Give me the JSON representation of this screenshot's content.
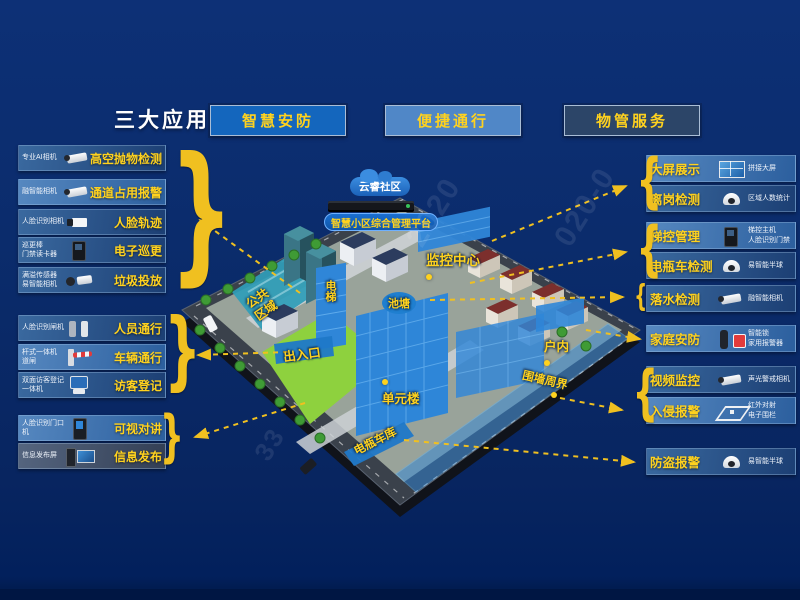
{
  "title": "三大应用",
  "apps": [
    {
      "label": "智慧安防"
    },
    {
      "label": "便捷通行"
    },
    {
      "label": "物管服务"
    }
  ],
  "colors": {
    "background": "#0b2c6c",
    "accent_yellow": "#ffd21e",
    "arrow_yellow": "#f0c020",
    "app1_bg": "#1466bd",
    "app2_bg": "#5087c7",
    "app3_bg": "#2c4568",
    "highlight_blue": "#2f86d8"
  },
  "left_groups": [
    {
      "items": [
        {
          "device": "专业AI相机",
          "feature": "高空抛物检测",
          "icon": "bullet-camera"
        },
        {
          "device": "融智能相机",
          "feature": "通道占用报警",
          "icon": "bullet-camera"
        },
        {
          "device": "人脸识别相机",
          "feature": "人脸轨迹",
          "icon": "box-camera"
        },
        {
          "device": "巡更棒\n门禁读卡器",
          "feature": "电子巡更",
          "icon": "card-reader"
        },
        {
          "device": "满溢传感器\n易智能相机",
          "feature": "垃圾投放",
          "icon": "overflow-sensor-camera"
        }
      ]
    },
    {
      "items": [
        {
          "device": "人脸识别闸机",
          "feature": "人员通行",
          "icon": "turnstile"
        },
        {
          "device": "杆式一体机\n道闸",
          "feature": "车辆通行",
          "icon": "barrier-gate"
        },
        {
          "device": "双面访客登记\n一体机",
          "feature": "访客登记",
          "icon": "visitor-terminal"
        }
      ]
    },
    {
      "items": [
        {
          "device": "人脸识别门口\n机",
          "feature": "可视对讲",
          "icon": "door-station"
        },
        {
          "device": "信息发布屏",
          "feature": "信息发布",
          "icon": "info-screen"
        }
      ]
    }
  ],
  "right_groups": [
    {
      "items": [
        {
          "feature": "大屏展示",
          "device": "拼接大屏",
          "icon": "video-wall"
        },
        {
          "feature": "离岗检测",
          "device": "区域人数统计",
          "icon": "dome-camera"
        }
      ]
    },
    {
      "items": [
        {
          "feature": "梯控管理",
          "device": "梯控主机\n人脸识别门禁",
          "icon": "elevator-terminal"
        },
        {
          "feature": "电瓶车检测",
          "device": "易智能半球",
          "icon": "dome-camera"
        }
      ]
    },
    {
      "items": [
        {
          "feature": "落水检测",
          "device": "融智能相机",
          "icon": "bullet-camera"
        }
      ]
    },
    {
      "items": [
        {
          "feature": "家庭安防",
          "device": "智能锁\n家用报警器",
          "icon": "smart-lock-alarm"
        }
      ]
    },
    {
      "items": [
        {
          "feature": "视频监控",
          "device": "声光警戒相机",
          "icon": "bullet-camera"
        },
        {
          "feature": "入侵报警",
          "device": "红外对射\n电子围栏",
          "icon": "perimeter-fence"
        }
      ]
    },
    {
      "items": [
        {
          "feature": "防盗报警",
          "device": "易智能半球",
          "icon": "dome-camera"
        }
      ]
    }
  ],
  "map": {
    "cloud_label": "云睿社区",
    "platform_label": "智慧小区综合管理平台",
    "labels": {
      "monitor_center": "监控中心",
      "elevator": "电梯",
      "pond": "池塘",
      "public_area": "公共\n区域",
      "entrance": "出入口",
      "unit_building": "单元楼",
      "indoor": "户内",
      "perimeter": "围墙周界",
      "ebike_garage": "电瓶车库"
    }
  },
  "decor": {
    "brace_left": "}",
    "brace_right": "{"
  },
  "watermark": {
    "segments": [
      "2020",
      "020-0",
      "33"
    ]
  }
}
